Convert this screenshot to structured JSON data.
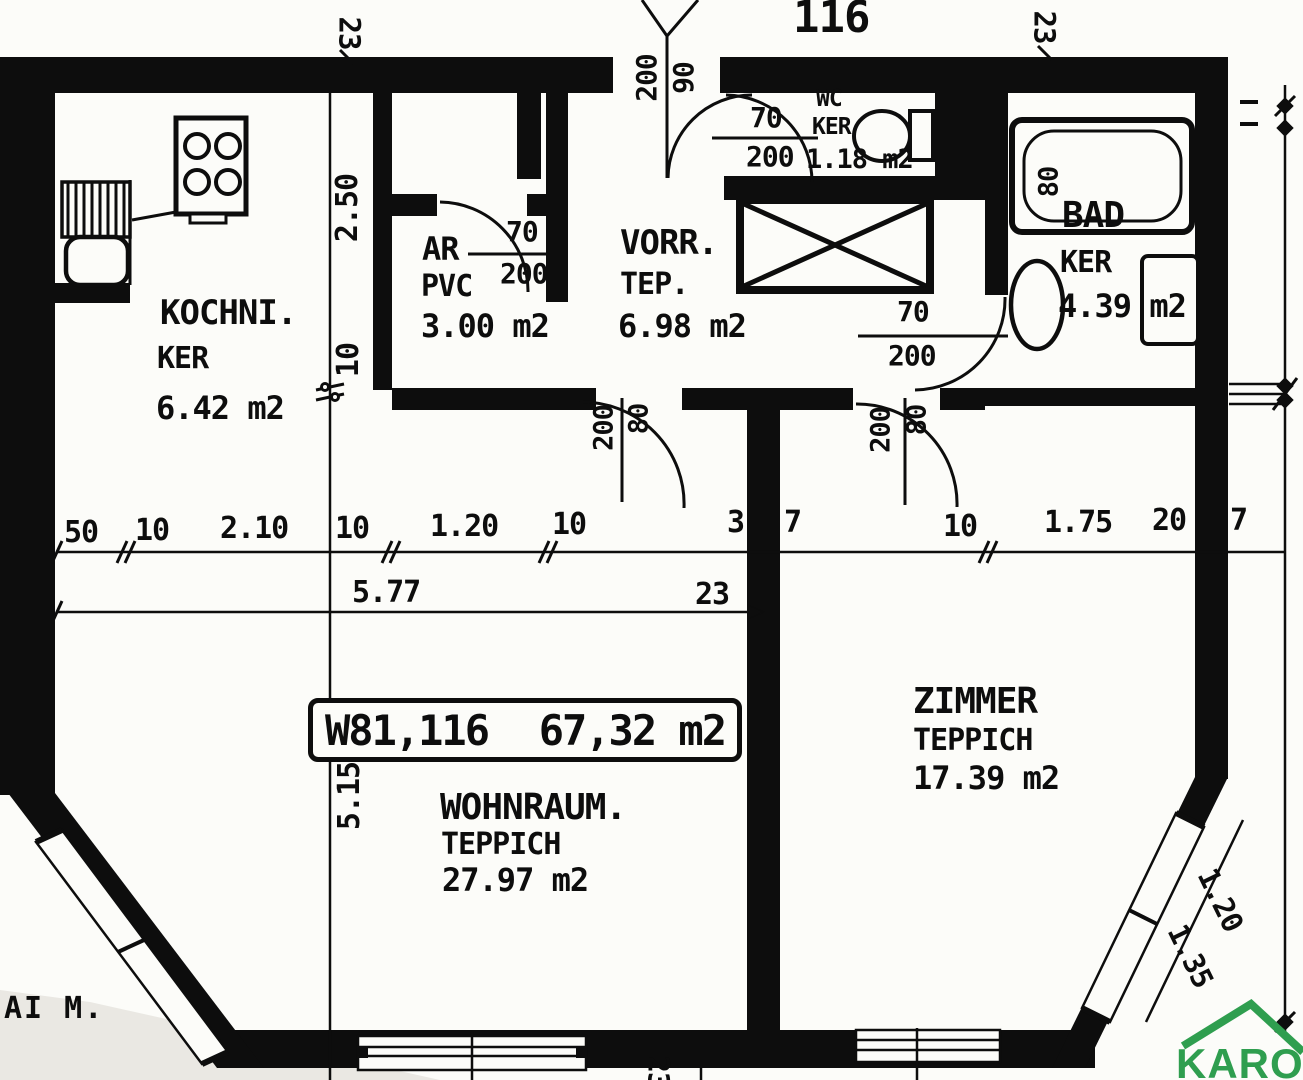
{
  "header": {
    "apartment_number": "116"
  },
  "unit_box": {
    "code": "W81,116",
    "area": "67,32 m2"
  },
  "rooms": {
    "kitchen": {
      "name": "KOCHNI.",
      "floor": "KER",
      "area": "6.42 m2"
    },
    "storage": {
      "name": "AR",
      "floor": "PVC",
      "area": "3.00 m2"
    },
    "hall": {
      "name": "VORR.",
      "floor": "TEP.",
      "area": "6.98 m2"
    },
    "wc": {
      "name": "WC",
      "floor": "KER",
      "area": "1.18 m2"
    },
    "bath": {
      "name": "BAD",
      "floor": "KER",
      "area": "4.39 m2"
    },
    "room": {
      "name": "ZIMMER",
      "floor": "TEPPICH",
      "area": "17.39 m2"
    },
    "living": {
      "name": "WOHNRAUM.",
      "floor": "TEPPICH",
      "area": "27.97 m2"
    }
  },
  "doors": {
    "entrance": {
      "w": "90",
      "h": "200"
    },
    "wc": {
      "w": "70",
      "h": "200"
    },
    "storage": {
      "w": "70",
      "h": "200"
    },
    "bath": {
      "w": "70",
      "h": "200"
    },
    "living": {
      "w": "80",
      "h": "200"
    },
    "room": {
      "w": "80",
      "h": "200"
    }
  },
  "dimensions": {
    "top_left": "23",
    "top_right": "23",
    "bottom": "23",
    "main_row": [
      "50",
      "10",
      "2.10",
      "10",
      "1.20",
      "10",
      "3",
      "7",
      "10",
      "1.75",
      "20",
      "7"
    ],
    "sub_total": "5.77",
    "sub_end": "23",
    "kitchen_width": "2.50",
    "wall_thickness": "10",
    "left_height": "5.15",
    "tub_width": "80",
    "bay": [
      "1.20",
      "1.35"
    ]
  },
  "margin_note": "AI M.",
  "branding": {
    "logo_text": "KAROS",
    "logo_color": "#2f9e4f"
  }
}
